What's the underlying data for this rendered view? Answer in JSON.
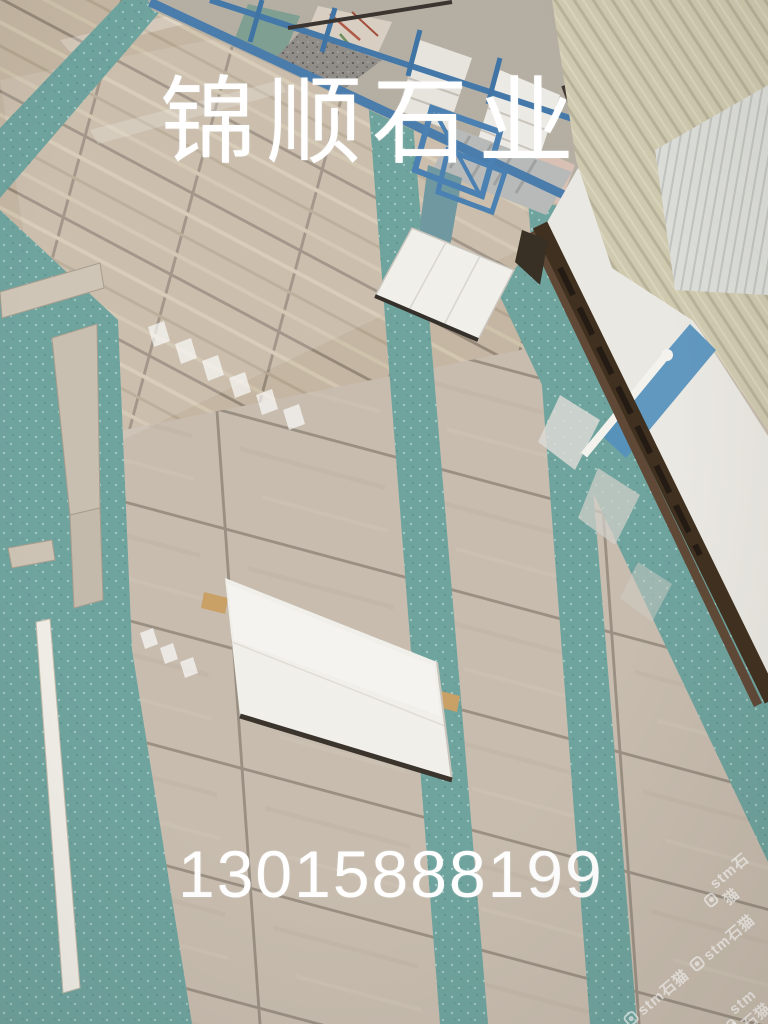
{
  "photo": {
    "description": "Stone factory showroom floor photographed at an oblique angle: beige marble display tiles with teal terrazzo strips, white slabs laid out, blue steel slab racks at top, white warehouse wall with cream corrugated panels on the right",
    "overlay": {
      "title": "锦顺石业",
      "phone": "13015888199"
    },
    "watermark": {
      "text": "stm石猫",
      "logo_icon": "stone-cat-app-logo",
      "instances": 4
    },
    "palette": {
      "tile_beige": "#c7bcae",
      "tile_tan_upper": "#c4b6a2",
      "grout": "#998f82",
      "teal_floor": "#6fa39e",
      "teal_speckle": "#b8d8d2",
      "rack_blue": "#4a7cac",
      "concrete_gray": "#b5afa3",
      "wall_white": "#eae8e2",
      "wall_blue_stripe": "#5590bd",
      "panel_cream": "#cfc9af",
      "gutter_brown": "#40301f",
      "slab_white": "#f0efea",
      "wood_block": "#c9a065",
      "text_white": "#ffffff"
    }
  }
}
